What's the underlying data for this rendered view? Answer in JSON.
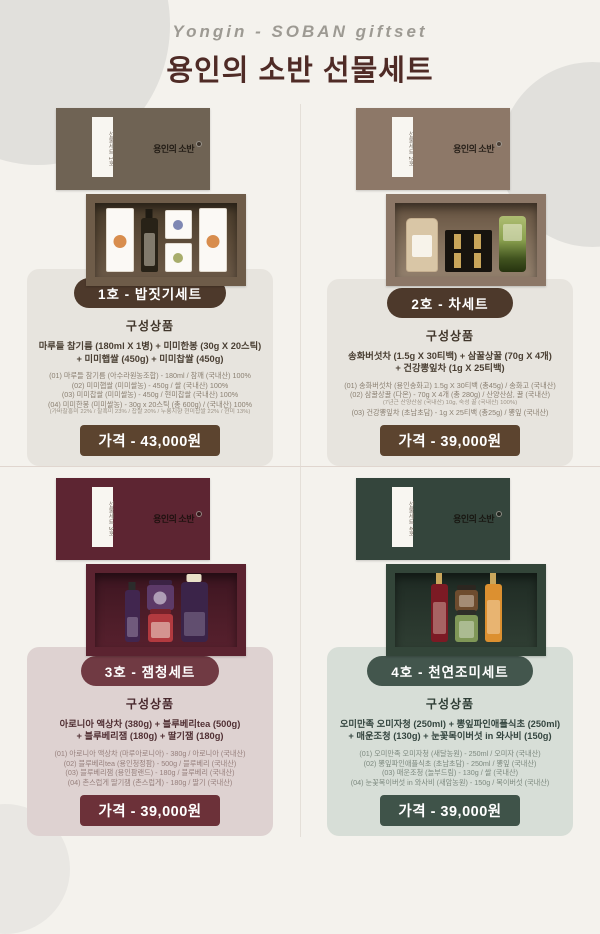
{
  "header": {
    "script_title": "Yongin - SOBAN giftset",
    "title": "용인의 소반 선물세트"
  },
  "colors": {
    "paper": "#f4f2ed",
    "title": "#4f2b26",
    "badge_brown": "#4d392b",
    "badge_maroon": "#703a43",
    "badge_green": "#43564d",
    "price_brown": "#5c442f",
    "price_maroon": "#6c3139",
    "price_green": "#3f5349",
    "card_gray": "#e7e4de",
    "card_pink": "#ded2d1",
    "card_sage": "#d7ded7"
  },
  "sections": [
    {
      "id": "1",
      "theme": "brown",
      "badge": "1호 - 밥짓기세트",
      "heading": "구성상품",
      "summary_line1": "마루들 참기름 (180ml X 1병) + 미미한봉 (30g X 20스틱)",
      "summary_line2": "+ 미미햅쌀 (450g) + 미미찹쌀 (450g)",
      "details": [
        {
          "t": "(01) 마루들 참기름 (아수라원농조합) - 180ml / 참깨 (국내산) 100%",
          "s": false
        },
        {
          "t": "(02) 미미햅쌀 (미미쌀농) - 450g / 쌀 (국내산) 100%",
          "s": false
        },
        {
          "t": "(03) 미미찹쌀 (미미쌀농) - 450g / 현미찹쌀 (국내산) 100%",
          "s": false
        },
        {
          "t": "(04) 미미한봉 (미미쌀농) - 30g x 20스틱 (총 600g) / (국내산) 100%",
          "s": false
        },
        {
          "t": "(가바찰홍미 22% / 찰흑미 23% / 찹쌀 20% / 누룽지향 현미찹쌀 22% / 현미 13%)",
          "s": true
        }
      ],
      "price": "가격 - 43,000원",
      "photo": {
        "lid_label": "선물세트 1호",
        "logo": "용인의 소반",
        "items": [
          {
            "name": "rice-package"
          },
          {
            "name": "sesame-oil-bottle"
          },
          {
            "stack": [
              {
                "name": "mini-packet-blue"
              },
              {
                "name": "mini-packet-green"
              }
            ]
          },
          {
            "name": "rice-package"
          }
        ]
      }
    },
    {
      "id": "2",
      "theme": "brown",
      "badge": "2호 - 차세트",
      "heading": "구성상품",
      "summary_line1": "송화버섯차 (1.5g X 30티백) + 삼꿀상꿀 (70g X 4개)",
      "summary_line2": "+ 건강뽕잎차 (1g X 25티백)",
      "details": [
        {
          "t": "(01) 송화버섯차 (용인송화고) 1.5g X 30티백 (총45g) / 송화고 (국내산)",
          "s": false
        },
        {
          "t": "(02) 삼꿀상꿀 (다온) - 70g X 4개 (총 280g) / 산양산삼, 꿀 (국내산)",
          "s": false
        },
        {
          "t": "(7년근 산양산삼 (국내산) 10g, 숙성 꿀 (국내산) 100%)",
          "s": true
        },
        {
          "t": "(03) 건강뽕잎차 (초남초담) - 1g X 25티백 (총25g) / 뽕잎 (국내산)",
          "s": false
        }
      ],
      "price": "가격 - 39,000원",
      "photo": {
        "lid_label": "선물세트 2호",
        "logo": "용인의 소반",
        "items": [
          {
            "name": "mushroom-tea-canister"
          },
          {
            "name": "honey-stick-tray"
          },
          {
            "name": "mulberry-tea-tin"
          }
        ]
      }
    },
    {
      "id": "3",
      "theme": "maroon",
      "badge": "3호 - 잼청세트",
      "heading": "구성상품",
      "summary_line1": "아로니아 액상차 (380g) + 블루베리tea (500g)",
      "summary_line2": "+ 블루베리잼 (180g) + 딸기잼 (180g)",
      "details": [
        {
          "t": "(01) 아로니아 액상차 (마루아로니아) - 380g / 아로니아 (국내산)",
          "s": false
        },
        {
          "t": "(02) 블루베리tea (용인청정팜) - 500g / 블루베리 (국내산)",
          "s": false
        },
        {
          "t": "(03) 블루베리잼 (용인팜랜드) - 180g / 블루베리 (국내산)",
          "s": false
        },
        {
          "t": "(04) 촌스럽게 딸기잼 (촌스럽게) - 180g / 딸기 (국내산)",
          "s": false
        }
      ],
      "price": "가격 - 39,000원",
      "photo": {
        "lid_label": "선물세트 3호",
        "logo": "용인의 소반",
        "items": [
          {
            "name": "aronia-bottle"
          },
          {
            "stack": [
              {
                "name": "blueberry-jam-jar"
              },
              {
                "name": "strawberry-jam-jar"
              }
            ]
          },
          {
            "name": "blueberry-tea-bottle"
          }
        ]
      }
    },
    {
      "id": "4",
      "theme": "green",
      "badge": "4호 - 천연조미세트",
      "heading": "구성상품",
      "summary_line1": "오미만족 오미자청 (250ml) + 뽕잎파인애플식초 (250ml)",
      "summary_line2": "+ 매운조청 (130g) + 눈꽃목이버섯 in 와사비 (150g)",
      "details": [
        {
          "t": "(01) 오미만족 오미자청 (새달농원) - 250ml / 오미자 (국내산)",
          "s": false
        },
        {
          "t": "(02) 뽕잎파인애플식초 (초남초담) - 250ml / 뽕잎 (국내산)",
          "s": false
        },
        {
          "t": "(03) 매운조청 (놀부드림) - 130g / 쌀 (국내산)",
          "s": false
        },
        {
          "t": "(04) 눈꽃목이버섯 in 와사비 (새암농원) - 150g / 목이버섯 (국내산)",
          "s": false
        }
      ],
      "price": "가격 - 39,000원",
      "photo": {
        "lid_label": "선물세트 4호",
        "logo": "용인의 소반",
        "items": [
          {
            "name": "omija-bottle"
          },
          {
            "stack": [
              {
                "name": "chojung-jar"
              },
              {
                "name": "wasabi-jar"
              }
            ]
          },
          {
            "name": "vinegar-bottle"
          }
        ]
      }
    }
  ]
}
